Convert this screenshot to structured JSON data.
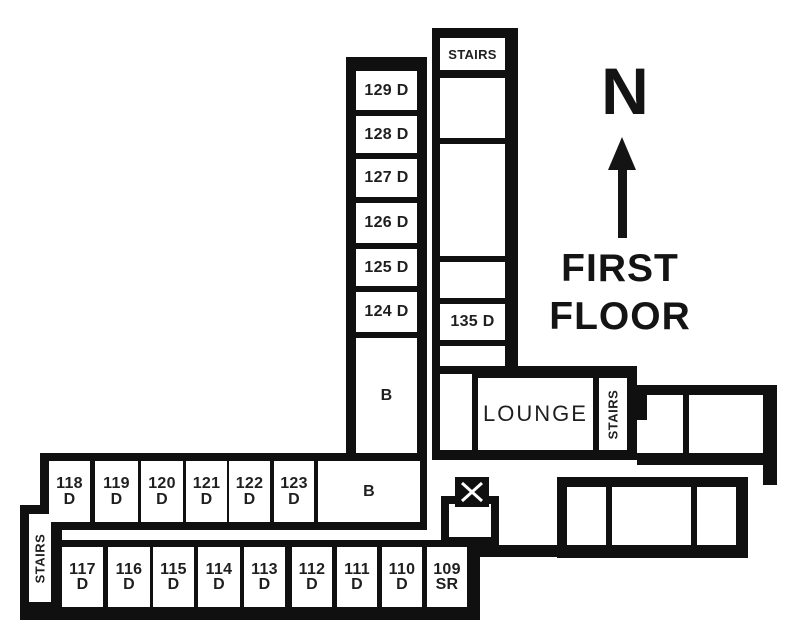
{
  "floor_title": {
    "line1": "FIRST",
    "line2": "FLOOR"
  },
  "compass": {
    "north": "N"
  },
  "north_wing": {
    "west_rooms": [
      "129 D",
      "128 D",
      "127 D",
      "126 D",
      "125 D",
      "124 D"
    ],
    "bath": "B",
    "stairs_top": "STAIRS",
    "room_135": "135 D"
  },
  "center": {
    "lounge": "LOUNGE",
    "stairs_east": "STAIRS"
  },
  "west_wing": {
    "stairs_west": "STAIRS",
    "bath": "B",
    "top_row": [
      {
        "num": "118",
        "suffix": "D"
      },
      {
        "num": "119",
        "suffix": "D"
      },
      {
        "num": "120",
        "suffix": "D"
      },
      {
        "num": "121",
        "suffix": "D"
      },
      {
        "num": "122",
        "suffix": "D"
      },
      {
        "num": "123",
        "suffix": "D"
      }
    ],
    "bottom_row": [
      {
        "num": "117",
        "suffix": "D"
      },
      {
        "num": "116",
        "suffix": "D"
      },
      {
        "num": "115",
        "suffix": "D"
      },
      {
        "num": "114",
        "suffix": "D"
      },
      {
        "num": "113",
        "suffix": "D"
      },
      {
        "num": "112",
        "suffix": "D"
      },
      {
        "num": "111",
        "suffix": "D"
      },
      {
        "num": "110",
        "suffix": "D"
      },
      {
        "num": "109",
        "suffix": "SR"
      }
    ]
  },
  "colors": {
    "wall": "#101010",
    "text": "#1f1f1f",
    "background": "#ffffff"
  }
}
